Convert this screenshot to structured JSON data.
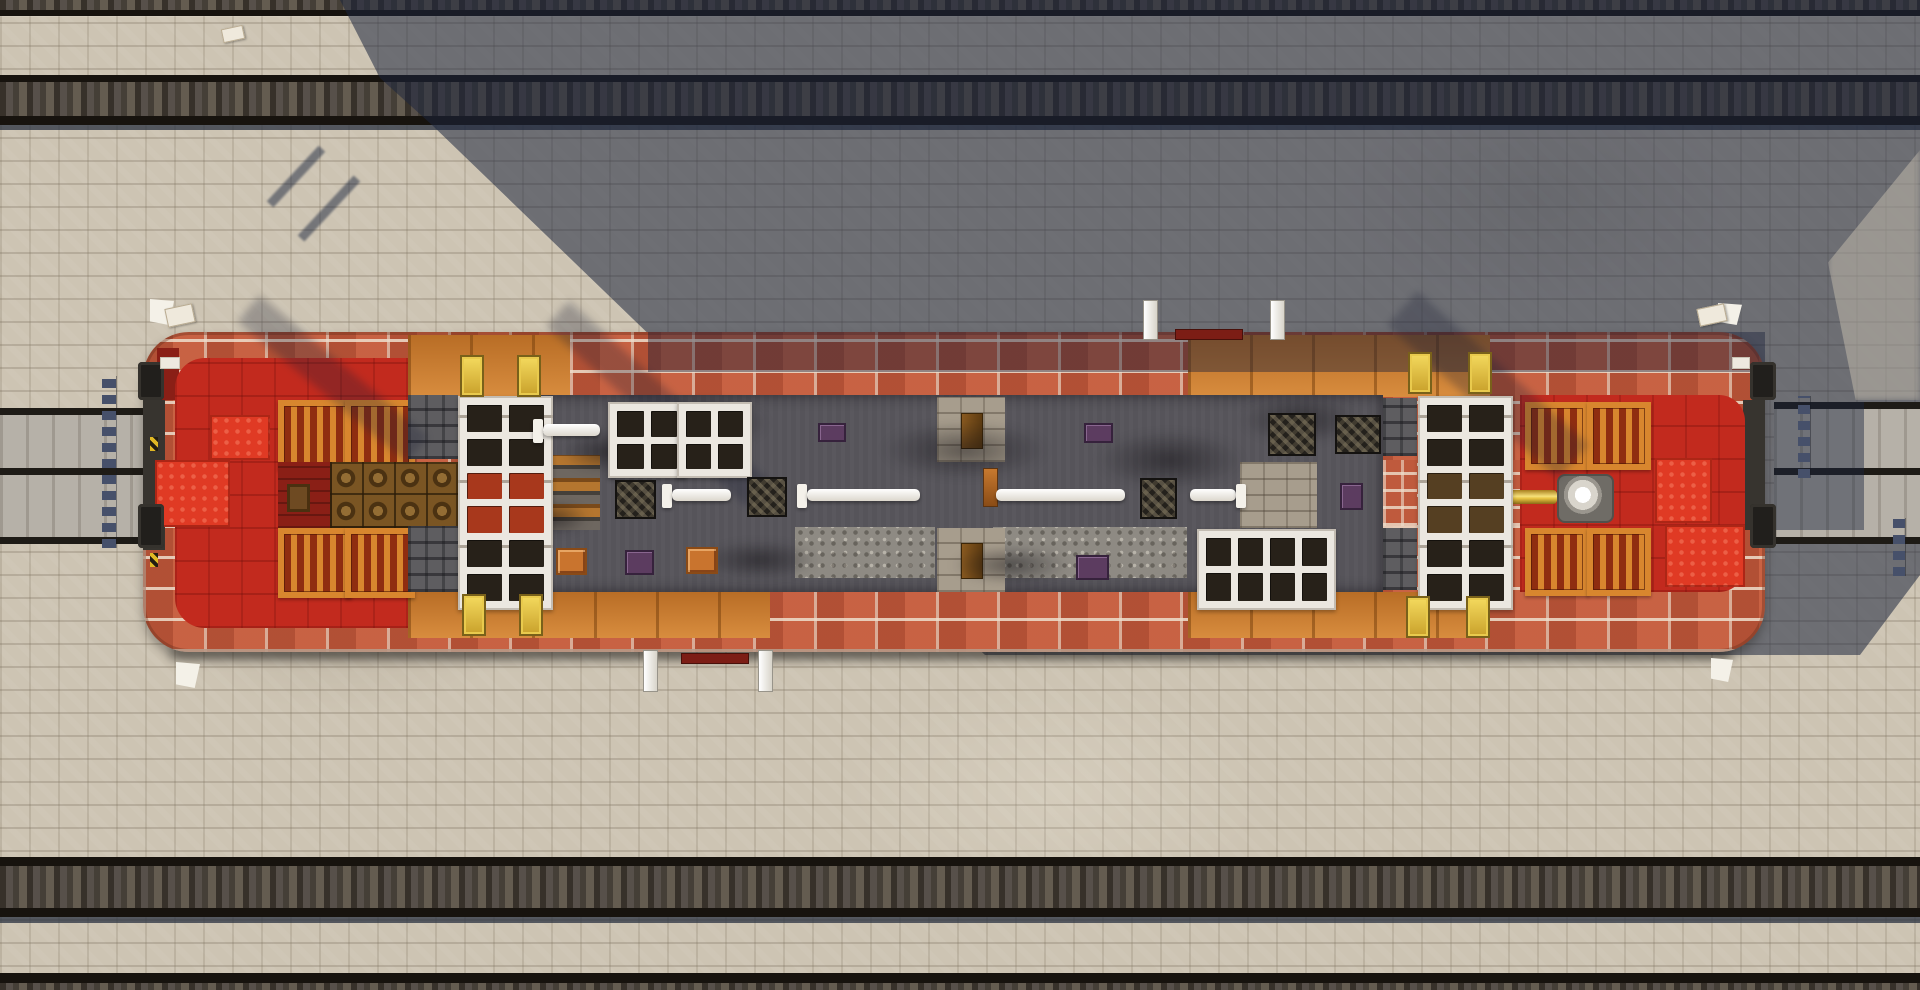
{
  "scene": {
    "game": "Minecraft",
    "view": "top-down aerial screenshot",
    "description": "Long orange-brick vessel with white skylight cabins, red bow and stern rooms, orange shutter grids, barrels, gold posts and a dark central deck, docked on gray guide beams between parallel railway tracks on a beige stone-brick yard; a large diagonal building shadow covers the upper-right area.",
    "time_of_day": "day",
    "hud_text": ""
  },
  "colors": {
    "ground": "#cdc4b3",
    "rail": "#17130e",
    "tie_mid": "#57504a",
    "tie_dark": "#37312a",
    "tie_dark2": "#453f37",
    "tie_light": "#645c50",
    "shadow_blue": "#1b253d",
    "brick": "#bf5a3d",
    "mortar": "#eedecc",
    "orange_wood": "#cd7d2e",
    "gold": "#e8c443",
    "red_base": "#c22a1e",
    "red_bright": "#e03a24",
    "red_dark": "#8a1f16",
    "trap_frame": "#d8862e",
    "trap_slat": "#8f2d10",
    "barrel": "#7a5523",
    "white_block": "#ebe7e0",
    "window_dark": "#272119",
    "window_lit": "#a8381c",
    "deck": "#56545a",
    "gravel": "#8e8a83",
    "platform": "#a79d8d",
    "stone_dark": "#5e5d60",
    "grate": "#24211c",
    "beam": "#b6b1a8",
    "beam_edge": "#1e1b16",
    "chain": "#46506a",
    "mast_bar": "#7c1d15",
    "plate_orange": "#c9742e",
    "plate_purple": "#5c3c60"
  },
  "objects": [
    {
      "type": "smoke",
      "name": "soot-smudge",
      "x": 560,
      "y": 430,
      "w": 90,
      "h": 44
    },
    {
      "type": "smoke",
      "name": "soot-smudge",
      "x": 640,
      "y": 395,
      "w": 130,
      "h": 55
    },
    {
      "type": "smoke",
      "name": "soot-smudge",
      "x": 700,
      "y": 540,
      "w": 120,
      "h": 40
    },
    {
      "type": "smoke",
      "name": "soot-smudge",
      "x": 880,
      "y": 420,
      "w": 170,
      "h": 60
    },
    {
      "type": "smoke",
      "name": "soot-smudge",
      "x": 950,
      "y": 545,
      "w": 120,
      "h": 40
    },
    {
      "type": "smoke",
      "name": "soot-smudge",
      "x": 1095,
      "y": 430,
      "w": 150,
      "h": 60
    },
    {
      "type": "smoke",
      "name": "soot-smudge",
      "x": 1240,
      "y": 395,
      "w": 120,
      "h": 50
    },
    {
      "type": "smoke",
      "name": "soot-smudge",
      "x": 520,
      "y": 500,
      "w": 70,
      "h": 36
    },
    {
      "type": "windows",
      "name": "cabin-left",
      "x": 458,
      "y": 396,
      "w": 77,
      "h": 196,
      "cols": 2,
      "rows": 6,
      "lit": [
        4,
        5,
        6,
        7
      ],
      "seams": true
    },
    {
      "type": "windows",
      "name": "cabin-right",
      "x": 1418,
      "y": 396,
      "w": 77,
      "h": 196,
      "cols": 2,
      "rows": 6,
      "amber": [
        4,
        5,
        6,
        7
      ],
      "seams": true
    },
    {
      "type": "windows",
      "name": "skylight-a",
      "x": 608,
      "y": 402,
      "w": 60,
      "h": 58,
      "cols": 2,
      "rows": 2
    },
    {
      "type": "windows",
      "name": "skylight-b",
      "x": 677,
      "y": 402,
      "w": 57,
      "h": 58,
      "cols": 2,
      "rows": 2
    },
    {
      "type": "windows",
      "name": "skylight-c",
      "x": 1197,
      "y": 529,
      "w": 121,
      "h": 63,
      "cols": 4,
      "rows": 2
    },
    {
      "type": "gold_post",
      "name": "gold-post",
      "x": 460,
      "y": 355,
      "w": 20,
      "h": 38
    },
    {
      "type": "gold_post",
      "name": "gold-post",
      "x": 517,
      "y": 355,
      "w": 20,
      "h": 38
    },
    {
      "type": "gold_post",
      "name": "gold-post",
      "x": 1408,
      "y": 352,
      "w": 20,
      "h": 38
    },
    {
      "type": "gold_post",
      "name": "gold-post",
      "x": 1468,
      "y": 352,
      "w": 20,
      "h": 38
    },
    {
      "type": "gold_post",
      "name": "gold-post",
      "x": 462,
      "y": 594,
      "w": 20,
      "h": 38
    },
    {
      "type": "gold_post",
      "name": "gold-post",
      "x": 519,
      "y": 594,
      "w": 20,
      "h": 38
    },
    {
      "type": "gold_post",
      "name": "gold-post",
      "x": 1406,
      "y": 596,
      "w": 20,
      "h": 38
    },
    {
      "type": "gold_post",
      "name": "gold-post",
      "x": 1466,
      "y": 596,
      "w": 20,
      "h": 38
    },
    {
      "type": "grate",
      "name": "black-grate",
      "x": 615,
      "y": 480,
      "w": 37,
      "h": 35
    },
    {
      "type": "grate",
      "name": "black-grate",
      "x": 747,
      "y": 477,
      "w": 36,
      "h": 36
    },
    {
      "type": "grate",
      "name": "black-grate",
      "x": 1140,
      "y": 478,
      "w": 33,
      "h": 37
    },
    {
      "type": "grate",
      "name": "black-grate",
      "x": 1268,
      "y": 413,
      "w": 44,
      "h": 39
    },
    {
      "type": "grate",
      "name": "black-grate",
      "x": 1335,
      "y": 415,
      "w": 42,
      "h": 35
    },
    {
      "type": "rodcap",
      "name": "end-rod-base",
      "x": 533,
      "y": 419,
      "w": 10,
      "h": 24
    },
    {
      "type": "rod",
      "name": "end-rod",
      "x": 543,
      "y": 424,
      "w": 57,
      "h": 12
    },
    {
      "type": "rodcap",
      "name": "end-rod-base",
      "x": 662,
      "y": 484,
      "w": 10,
      "h": 24
    },
    {
      "type": "rod",
      "name": "end-rod",
      "x": 672,
      "y": 489,
      "w": 59,
      "h": 12
    },
    {
      "type": "rodcap",
      "name": "end-rod-base",
      "x": 797,
      "y": 484,
      "w": 10,
      "h": 24
    },
    {
      "type": "rod",
      "name": "end-rod",
      "x": 807,
      "y": 489,
      "w": 113,
      "h": 12
    },
    {
      "type": "orange_knob",
      "name": "rod-knob",
      "x": 983,
      "y": 468,
      "w": 13,
      "h": 37
    },
    {
      "type": "rod",
      "name": "end-rod",
      "x": 996,
      "y": 489,
      "w": 129,
      "h": 12
    },
    {
      "type": "rod",
      "name": "end-rod",
      "x": 1190,
      "y": 489,
      "w": 46,
      "h": 12
    },
    {
      "type": "rodcap",
      "name": "end-rod-base",
      "x": 1236,
      "y": 484,
      "w": 10,
      "h": 24
    },
    {
      "type": "plate_orange",
      "name": "orange-crate",
      "x": 556,
      "y": 548,
      "w": 27,
      "h": 23
    },
    {
      "type": "plate_orange",
      "name": "orange-crate",
      "x": 686,
      "y": 547,
      "w": 28,
      "h": 23
    },
    {
      "type": "plate_purple",
      "name": "purple-plate",
      "x": 625,
      "y": 550,
      "w": 25,
      "h": 21
    },
    {
      "type": "plate_purple",
      "name": "purple-plate",
      "x": 818,
      "y": 423,
      "w": 24,
      "h": 15
    },
    {
      "type": "plate_purple",
      "name": "purple-plate",
      "x": 1084,
      "y": 423,
      "w": 25,
      "h": 16
    },
    {
      "type": "plate_purple",
      "name": "purple-plate",
      "x": 1076,
      "y": 555,
      "w": 29,
      "h": 21
    },
    {
      "type": "plate_purple",
      "name": "purple-plate",
      "x": 1340,
      "y": 483,
      "w": 19,
      "h": 23
    },
    {
      "type": "flag",
      "name": "corner-flag",
      "x": 150,
      "y": 299,
      "w": 24,
      "h": 26
    },
    {
      "type": "flag",
      "name": "corner-flag",
      "x": 176,
      "y": 662,
      "w": 24,
      "h": 26
    },
    {
      "type": "flag",
      "name": "corner-flag",
      "x": 1718,
      "y": 303,
      "w": 24,
      "h": 22
    },
    {
      "type": "flag",
      "name": "corner-flag",
      "x": 1711,
      "y": 658,
      "w": 22,
      "h": 24
    },
    {
      "type": "item",
      "name": "dropped-item",
      "x": 222,
      "y": 27,
      "w": 20,
      "h": 12
    },
    {
      "type": "item",
      "name": "dropped-item",
      "x": 166,
      "y": 306,
      "w": 26,
      "h": 17
    },
    {
      "type": "item",
      "name": "dropped-item",
      "x": 1698,
      "y": 306,
      "w": 26,
      "h": 16
    },
    {
      "type": "chain",
      "name": "mooring-chain",
      "x": 102,
      "y": 376,
      "w": 14,
      "h": 172
    },
    {
      "type": "chain",
      "name": "mooring-chain",
      "x": 1798,
      "y": 396,
      "w": 12,
      "h": 82
    },
    {
      "type": "chain",
      "name": "mooring-chain",
      "x": 1893,
      "y": 518,
      "w": 12,
      "h": 58
    },
    {
      "type": "mast_post",
      "name": "mast-post",
      "x": 1143,
      "y": 300,
      "w": 13,
      "h": 38
    },
    {
      "type": "mast_post",
      "name": "mast-post",
      "x": 1270,
      "y": 300,
      "w": 13,
      "h": 38
    },
    {
      "type": "mast_bar",
      "name": "mast-crossbar",
      "x": 1175,
      "y": 329,
      "w": 66,
      "h": 9
    },
    {
      "type": "mast_post",
      "name": "mast-post",
      "x": 643,
      "y": 650,
      "w": 13,
      "h": 40
    },
    {
      "type": "mast_post",
      "name": "mast-post",
      "x": 758,
      "y": 650,
      "w": 13,
      "h": 40
    },
    {
      "type": "mast_bar",
      "name": "mast-crossbar",
      "x": 681,
      "y": 653,
      "w": 66,
      "h": 9
    },
    {
      "type": "bumper",
      "name": "hull-bumper",
      "x": 138,
      "y": 362,
      "w": 26,
      "h": 38
    },
    {
      "type": "bumper",
      "name": "hull-bumper",
      "x": 138,
      "y": 504,
      "w": 26,
      "h": 44
    },
    {
      "type": "bumper",
      "name": "hull-bumper",
      "x": 1750,
      "y": 362,
      "w": 26,
      "h": 38
    },
    {
      "type": "bumper",
      "name": "hull-bumper",
      "x": 1750,
      "y": 504,
      "w": 26,
      "h": 44
    },
    {
      "type": "quartz",
      "name": "quartz-trim",
      "x": 160,
      "y": 357,
      "w": 18,
      "h": 10
    },
    {
      "type": "quartz",
      "name": "quartz-trim",
      "x": 1732,
      "y": 357,
      "w": 16,
      "h": 10
    },
    {
      "type": "caution",
      "name": "caution-stripe",
      "x": 150,
      "y": 437,
      "w": 8,
      "h": 14
    },
    {
      "type": "caution",
      "name": "caution-stripe",
      "x": 150,
      "y": 553,
      "w": 8,
      "h": 14
    }
  ]
}
